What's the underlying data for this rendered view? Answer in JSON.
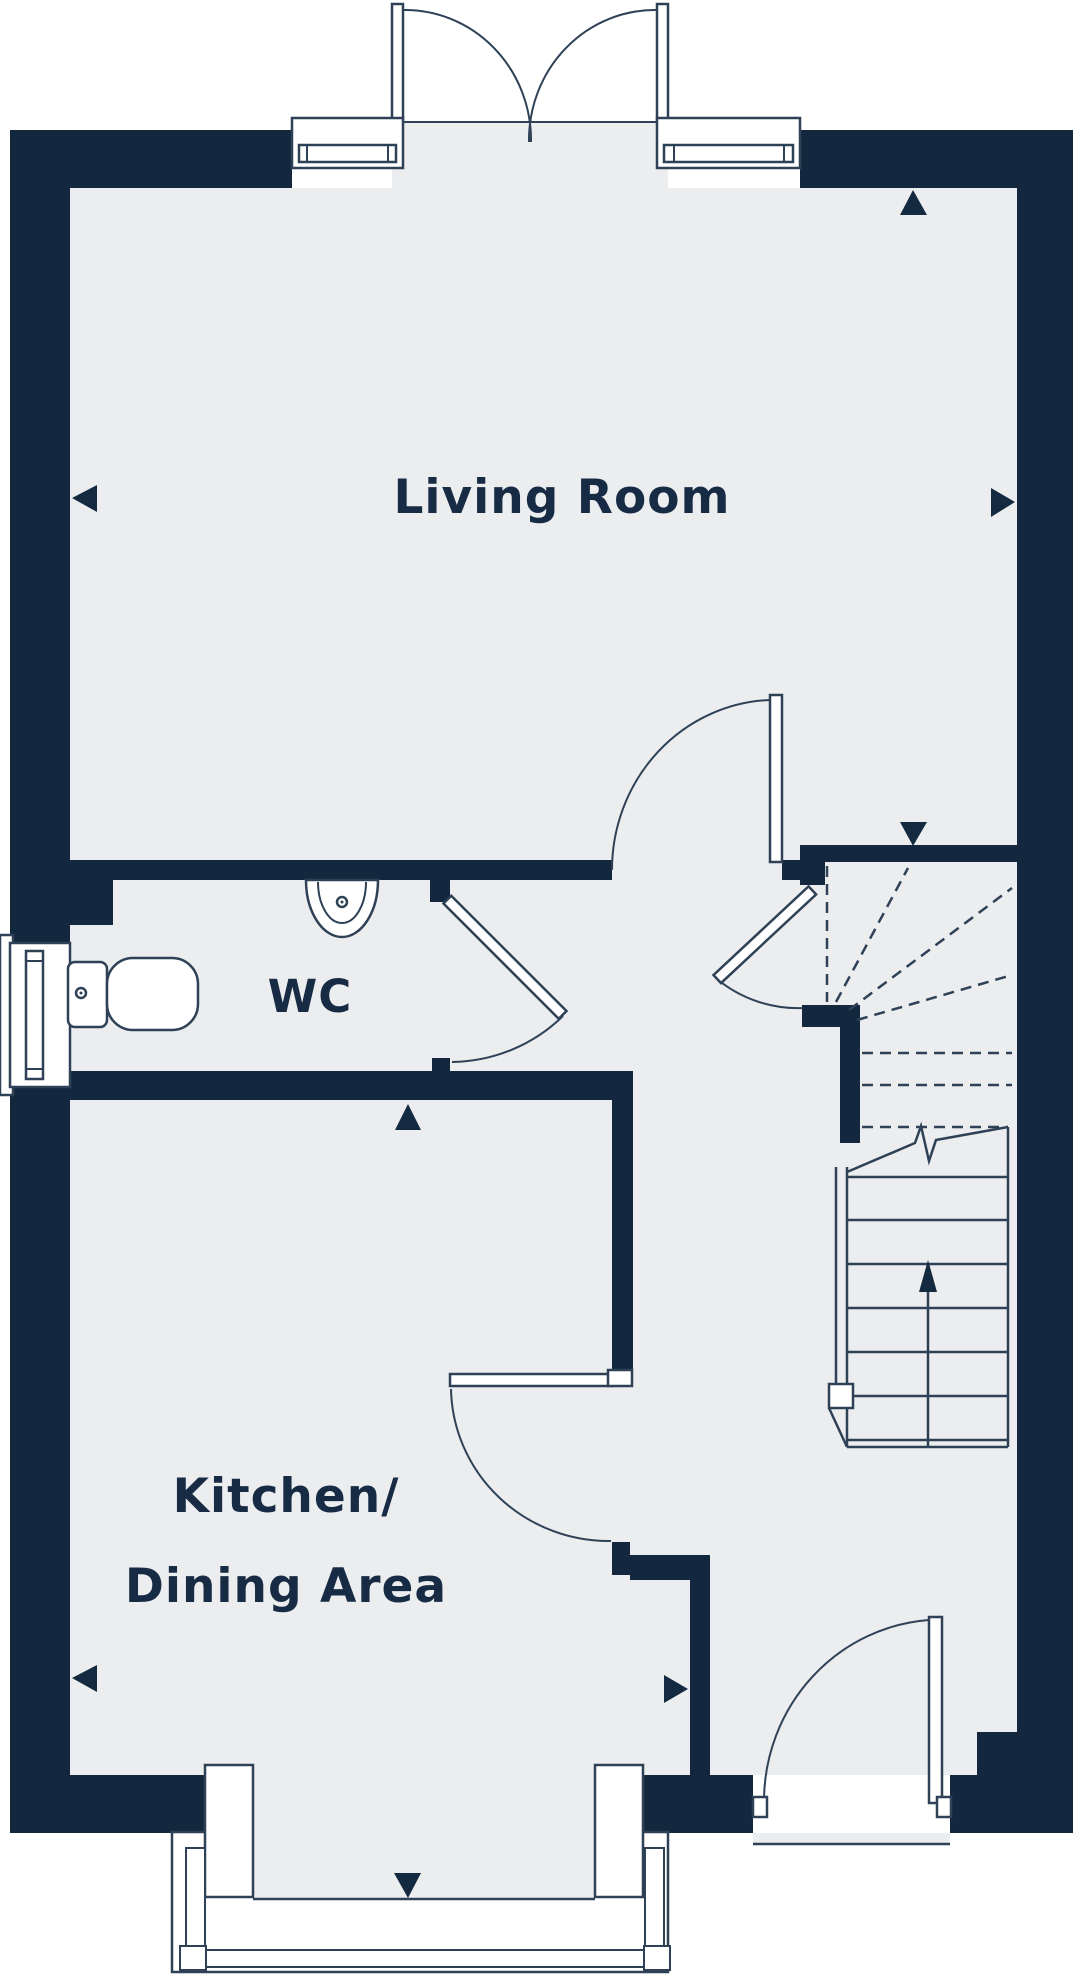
{
  "document": {
    "type": "floor-plan",
    "background": "#ffffff"
  },
  "colors": {
    "wall": "#13283e",
    "floor": "#ecedef",
    "outline": "#2e4156",
    "text": "#172b44",
    "marker": "#142a40",
    "fixture_fill": "#ffffff"
  },
  "rooms": {
    "living_room": {
      "label": "Living Room"
    },
    "wc": {
      "label": "WC"
    },
    "kitchen": {
      "label_line1": "Kitchen/",
      "label_line2": "Dining Area"
    }
  },
  "fixtures": {
    "toilet": "toilet-icon",
    "sink": "sink-icon",
    "stairs": {
      "icon": "stairs-icon",
      "tread_count": 7,
      "direction": "up",
      "winder_dashed_rays": 7
    },
    "doors": [
      "french-doors-top",
      "living-room-door",
      "wc-door",
      "understairs-cupboard-door",
      "kitchen-door",
      "front-door"
    ],
    "windows": [
      "window-top-left",
      "window-top-right",
      "window-wc-left",
      "bay-window-bottom"
    ]
  },
  "direction_markers": [
    {
      "name": "marker-top-right",
      "symbol": "▲"
    },
    {
      "name": "marker-living-left",
      "symbol": "◀"
    },
    {
      "name": "marker-living-right",
      "symbol": "▶"
    },
    {
      "name": "marker-hall-down",
      "symbol": "▼"
    },
    {
      "name": "marker-kitchen-up",
      "symbol": "▲"
    },
    {
      "name": "marker-kitchen-left",
      "symbol": "◀"
    },
    {
      "name": "marker-kitchen-right",
      "symbol": "▶"
    },
    {
      "name": "marker-bay-down",
      "symbol": "▼"
    }
  ]
}
